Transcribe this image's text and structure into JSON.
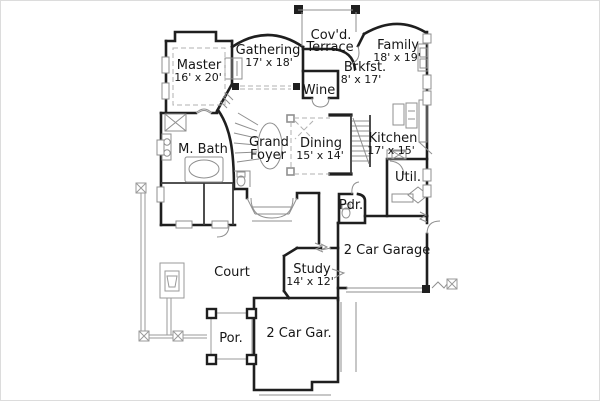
{
  "figure": {
    "kind": "architectural floor plan",
    "background_color": "#ffffff",
    "wall_color": "#1f1f1f",
    "detail_color": "#8f8f8f",
    "text_color": "#161616"
  },
  "rooms": {
    "terrace": {
      "line1": "Cov'd.",
      "line2": "Terrace"
    },
    "master": {
      "name": "Master",
      "dims": "16' x 20'"
    },
    "gathering": {
      "name": "Gathering",
      "dims": "17' x 18'"
    },
    "family": {
      "name": "Family",
      "dims": "18' x 19'"
    },
    "brkfst": {
      "name": "Brkfst.",
      "dims": "8' x 17'"
    },
    "wine": {
      "name": "Wine"
    },
    "foyer": {
      "line1": "Grand",
      "line2": "Foyer"
    },
    "dining": {
      "name": "Dining",
      "dims": "15' x 14'"
    },
    "kitchen": {
      "name": "Kitchen",
      "dims": "17' x 15'"
    },
    "mbath": {
      "name": "M. Bath"
    },
    "util": {
      "name": "Util."
    },
    "pdr": {
      "name": "Pdr."
    },
    "garage": {
      "name": "2 Car Garage"
    },
    "court": {
      "name": "Court"
    },
    "study": {
      "name": "Study",
      "dims": "14' x 12'"
    },
    "por": {
      "name": "Por."
    },
    "gar2": {
      "name": "2 Car Gar."
    }
  }
}
